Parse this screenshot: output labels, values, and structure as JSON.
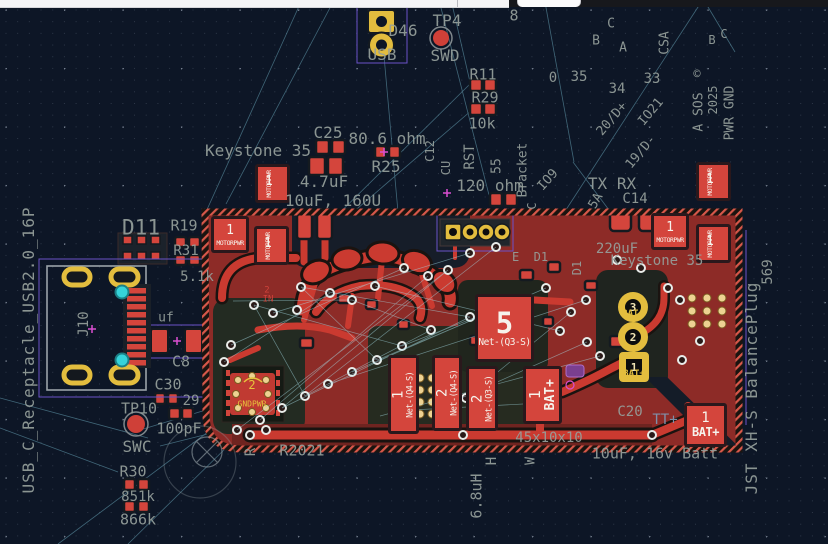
{
  "app": {
    "name": "pcb-editor-canvas"
  },
  "colors": {
    "background": "#0d1626",
    "copper_pour": "#8d2b27",
    "copper_bright": "#ca3a30",
    "pad_red": "#d4453c",
    "silkscreen_gray": "#96a09c",
    "gold_pad": "#e3bd3e",
    "via_cyan": "#35d3da",
    "ratsnest_teal": "#a8e0ea",
    "courtyard_purple": "#6a52c8",
    "magenta_marker": "#d94fd0"
  },
  "labels": [
    {
      "t": "TP4",
      "x": 447,
      "y": 21,
      "s": 16
    },
    {
      "t": "D46",
      "x": 403,
      "y": 31,
      "s": 16
    },
    {
      "t": "USB",
      "x": 382,
      "y": 55,
      "s": 16
    },
    {
      "t": "SWD",
      "x": 445,
      "y": 56,
      "s": 16
    },
    {
      "t": "8",
      "x": 514,
      "y": 16,
      "s": 15
    },
    {
      "t": "R11",
      "x": 483,
      "y": 75,
      "s": 15
    },
    {
      "t": "R29",
      "x": 485,
      "y": 98,
      "s": 15
    },
    {
      "t": "10k",
      "x": 482,
      "y": 124,
      "s": 15
    },
    {
      "t": "C",
      "x": 611,
      "y": 24,
      "s": 13
    },
    {
      "t": "B",
      "x": 596,
      "y": 41,
      "s": 13
    },
    {
      "t": "A",
      "x": 623,
      "y": 48,
      "s": 13
    },
    {
      "t": "CSA",
      "x": 665,
      "y": 43,
      "r": -90,
      "s": 13
    },
    {
      "t": "0",
      "x": 553,
      "y": 78,
      "s": 14
    },
    {
      "t": "35",
      "x": 579,
      "y": 77,
      "s": 14
    },
    {
      "t": "34",
      "x": 617,
      "y": 89,
      "s": 14
    },
    {
      "t": "33",
      "x": 652,
      "y": 79,
      "s": 14
    },
    {
      "t": "20/D+",
      "x": 612,
      "y": 119,
      "r": -50,
      "s": 13
    },
    {
      "t": "IO21",
      "x": 651,
      "y": 112,
      "r": -50,
      "s": 13
    },
    {
      "t": "19/D-",
      "x": 641,
      "y": 152,
      "r": -50,
      "s": 13
    },
    {
      "t": "©",
      "x": 697,
      "y": 74,
      "s": 12
    },
    {
      "t": "A SOS",
      "x": 699,
      "y": 112,
      "r": -90,
      "s": 13
    },
    {
      "t": "2025",
      "x": 713,
      "y": 100,
      "r": -90,
      "s": 12
    },
    {
      "t": "PWR GND",
      "x": 730,
      "y": 113,
      "r": -90,
      "s": 13
    },
    {
      "t": "B",
      "x": 712,
      "y": 40,
      "s": 12
    },
    {
      "t": "C",
      "x": 724,
      "y": 34,
      "s": 12
    },
    {
      "t": "Keystone 35",
      "x": 258,
      "y": 151,
      "s": 16
    },
    {
      "t": "C25",
      "x": 328,
      "y": 133,
      "s": 16
    },
    {
      "t": "80.6 ohm",
      "x": 387,
      "y": 139,
      "s": 16
    },
    {
      "t": "R25",
      "x": 386,
      "y": 167,
      "s": 16
    },
    {
      "t": "4.7uF",
      "x": 324,
      "y": 182,
      "s": 16
    },
    {
      "t": "10uF, 160U",
      "x": 333,
      "y": 201,
      "s": 16
    },
    {
      "t": "RST",
      "x": 470,
      "y": 157,
      "r": -90,
      "s": 14
    },
    {
      "t": "55",
      "x": 497,
      "y": 166,
      "r": -90,
      "s": 13
    },
    {
      "t": "Bracket",
      "x": 523,
      "y": 170,
      "r": -90,
      "s": 13
    },
    {
      "t": "IO9",
      "x": 548,
      "y": 180,
      "r": -48,
      "s": 13
    },
    {
      "t": "C",
      "x": 532,
      "y": 206,
      "r": -90,
      "s": 12
    },
    {
      "t": "120 ohm",
      "x": 490,
      "y": 186,
      "s": 16
    },
    {
      "t": "TX RX",
      "x": 612,
      "y": 184,
      "s": 16
    },
    {
      "t": "C14",
      "x": 635,
      "y": 199,
      "s": 14
    },
    {
      "t": "5A",
      "x": 596,
      "y": 201,
      "r": -60,
      "s": 13
    },
    {
      "t": "C12",
      "x": 430,
      "y": 151,
      "r": -90,
      "s": 12
    },
    {
      "t": "CU",
      "x": 446,
      "y": 168,
      "r": -90,
      "s": 12
    },
    {
      "t": "D11",
      "x": 141,
      "y": 228,
      "s": 21
    },
    {
      "t": "R19",
      "x": 184,
      "y": 226,
      "s": 15
    },
    {
      "t": "R31",
      "x": 186,
      "y": 251,
      "s": 14
    },
    {
      "t": "5.1k",
      "x": 197,
      "y": 277,
      "s": 14
    },
    {
      "t": "uf",
      "x": 166,
      "y": 318,
      "s": 13
    },
    {
      "t": "C8",
      "x": 181,
      "y": 362,
      "s": 15
    },
    {
      "t": "C30",
      "x": 168,
      "y": 385,
      "s": 15
    },
    {
      "t": "29",
      "x": 191,
      "y": 401,
      "s": 14
    },
    {
      "t": "TP10",
      "x": 139,
      "y": 409,
      "s": 15
    },
    {
      "t": "100pF",
      "x": 179,
      "y": 429,
      "s": 15
    },
    {
      "t": "SWC",
      "x": 137,
      "y": 447,
      "s": 16
    },
    {
      "t": "R30",
      "x": 133,
      "y": 472,
      "s": 15
    },
    {
      "t": "851k",
      "x": 138,
      "y": 497,
      "s": 14
    },
    {
      "t": "866k",
      "x": 138,
      "y": 520,
      "s": 15
    },
    {
      "t": "USB_C_Receptacle_USB2.0_16P",
      "x": 29,
      "y": 350,
      "r": -90,
      "s": 16,
      "ls": 1
    },
    {
      "t": "J10",
      "x": 84,
      "y": 324,
      "r": -90,
      "s": 14
    },
    {
      "t": "R2021",
      "x": 302,
      "y": 451,
      "s": 15
    },
    {
      "t": "R",
      "x": 251,
      "y": 452,
      "r": -90,
      "s": 14
    },
    {
      "t": "6.8uH",
      "x": 477,
      "y": 496,
      "r": -90,
      "s": 15
    },
    {
      "t": "H",
      "x": 492,
      "y": 461,
      "r": -90,
      "s": 14
    },
    {
      "t": "W",
      "x": 531,
      "y": 461,
      "r": -90,
      "s": 13
    },
    {
      "t": "45x10x10",
      "x": 549,
      "y": 438,
      "s": 14
    },
    {
      "t": "10uF, 16v Batt",
      "x": 655,
      "y": 454,
      "s": 15
    },
    {
      "t": "C20",
      "x": 630,
      "y": 412,
      "s": 14
    },
    {
      "t": "TT+",
      "x": 665,
      "y": 420,
      "s": 14,
      "c": "b"
    },
    {
      "t": "220uF",
      "x": 617,
      "y": 249,
      "s": 14
    },
    {
      "t": "Keystone 35",
      "x": 657,
      "y": 261,
      "s": 14
    },
    {
      "t": "E  D1",
      "x": 530,
      "y": 257,
      "s": 12
    },
    {
      "t": "D1",
      "x": 577,
      "y": 268,
      "r": -90,
      "s": 12
    },
    {
      "t": "569",
      "x": 768,
      "y": 272,
      "r": -90,
      "s": 14
    },
    {
      "t": "JST XH-S BalancePlug",
      "x": 752,
      "y": 388,
      "r": -90,
      "s": 16,
      "ls": 1
    },
    {
      "t": "2",
      "x": 267,
      "y": 291,
      "s": 9,
      "c": "r"
    },
    {
      "t": "IN",
      "x": 268,
      "y": 300,
      "s": 9,
      "c": "r"
    }
  ],
  "motor_pads": {
    "num": "1",
    "name": "MOTORPWR",
    "items": [
      {
        "x": 255,
        "y": 164,
        "o": "v"
      },
      {
        "x": 211,
        "y": 216,
        "o": "h"
      },
      {
        "x": 254,
        "y": 226,
        "o": "v"
      },
      {
        "x": 651,
        "y": 213,
        "o": "h"
      },
      {
        "x": 696,
        "y": 162,
        "o": "v"
      },
      {
        "x": 696,
        "y": 224,
        "o": "v"
      }
    ]
  },
  "power_pads": [
    {
      "x": 475,
      "y": 294,
      "w": 59,
      "h": 68,
      "num": "5",
      "net": "Net-(Q3-S)",
      "style": "big"
    },
    {
      "x": 388,
      "y": 355,
      "w": 31,
      "h": 79,
      "num": "1",
      "net": "Net-(Q4-S)",
      "style": "vert"
    },
    {
      "x": 432,
      "y": 355,
      "w": 30,
      "h": 76,
      "num": "2",
      "net": "Net-(Q4-S)",
      "style": "vert"
    },
    {
      "x": 466,
      "y": 366,
      "w": 32,
      "h": 65,
      "num": "2",
      "net": "Net-(Q3-S)",
      "style": "vert"
    },
    {
      "x": 523,
      "y": 366,
      "w": 39,
      "h": 58,
      "num": "1",
      "net": "BAT+",
      "style": "vbig"
    },
    {
      "x": 684,
      "y": 403,
      "w": 43,
      "h": 44,
      "num": "1",
      "net": "BAT+",
      "style": "horiz"
    }
  ],
  "battery_connector": [
    {
      "x": 618,
      "y": 292,
      "num": "3",
      "label": "BAT-",
      "shape": "circle"
    },
    {
      "x": 618,
      "y": 322,
      "num": "2",
      "label": "",
      "shape": "circle"
    },
    {
      "x": 619,
      "y": 352,
      "num": "1",
      "label": "BAT+",
      "shape": "square"
    }
  ],
  "qfn": {
    "num": "2",
    "name": "GNDPWR",
    "x": 252,
    "y": 385,
    "ny": 404
  }
}
